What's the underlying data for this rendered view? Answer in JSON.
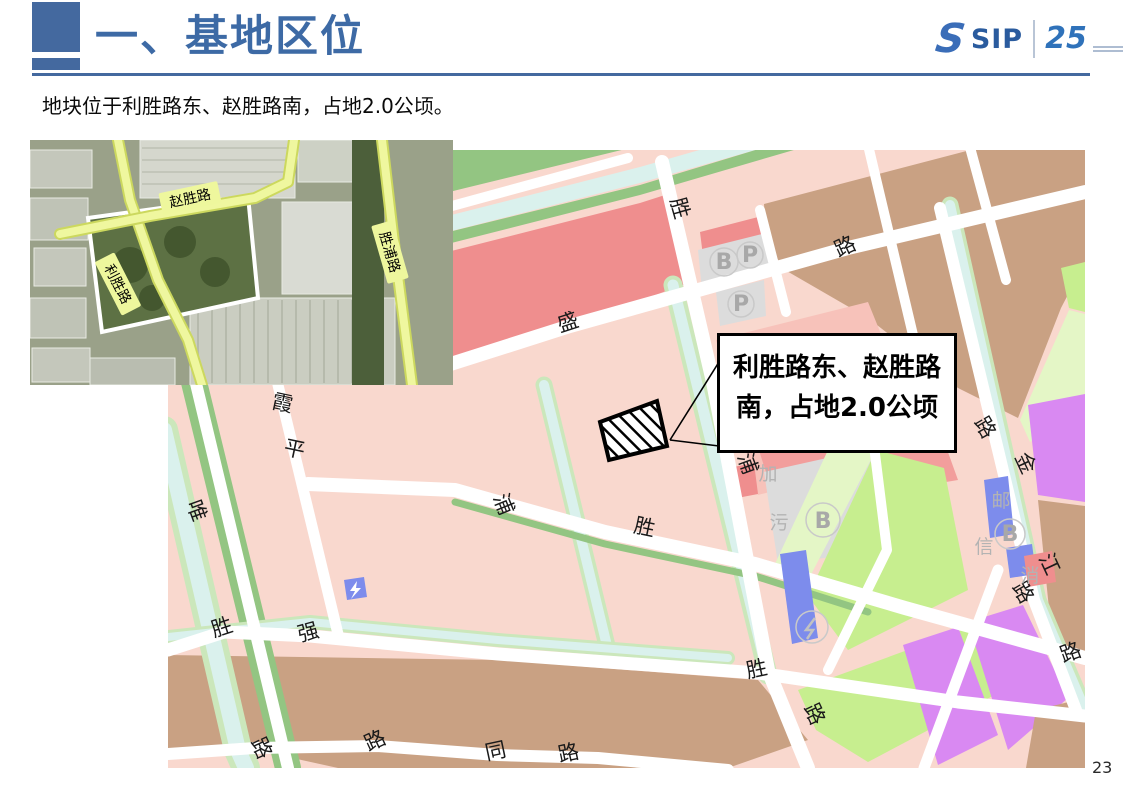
{
  "slide": {
    "title": "一、基地区位",
    "subtitle": "地块位于利胜路东、赵胜路南，占地2.0公顷。",
    "page_number": "23",
    "accent_color": "#44699f"
  },
  "logo": {
    "brand": "SIP",
    "anniversary": "25"
  },
  "callout": {
    "line1": "利胜路东、赵胜路",
    "line2": "南，占地2.0公顷"
  },
  "satellite": {
    "labels": [
      {
        "text": "赵胜路",
        "x": 160,
        "y": 58,
        "rot": -12
      },
      {
        "text": "利胜路",
        "x": 88,
        "y": 144,
        "rot": 63
      },
      {
        "text": "胜浦路",
        "x": 360,
        "y": 112,
        "rot": 74
      }
    ]
  },
  "map": {
    "colors": {
      "pink": "#f9d8ce",
      "pink_mid": "#f7c2ba",
      "pink_deep": "#f29e9c",
      "red": "#ef8e8e",
      "tan": "#c9a183",
      "green_strip": "#93c582",
      "green_light": "#c7ee8f",
      "green_pale": "#e4f6c6",
      "water": "#daf1ed",
      "water_edge": "#cbe7bb",
      "purple": "#d989f2",
      "blue": "#7d8cec",
      "gray": "#dcdcdc",
      "gray_text": "#b3b3b3",
      "road": "#ffffff"
    },
    "road_labels": [
      {
        "t": "胜",
        "x": 505,
        "y": 60,
        "r": 74
      },
      {
        "t": "盛",
        "x": 402,
        "y": 179,
        "r": -18
      },
      {
        "t": "路",
        "x": 680,
        "y": 103,
        "r": -25
      },
      {
        "t": "霞",
        "x": 113,
        "y": 260,
        "r": 12
      },
      {
        "t": "平",
        "x": 125,
        "y": 306,
        "r": 12
      },
      {
        "t": "唯",
        "x": 22,
        "y": 363,
        "r": 70
      },
      {
        "t": "浦",
        "x": 329,
        "y": 357,
        "r": 68
      },
      {
        "t": "胜",
        "x": 475,
        "y": 384,
        "r": 12
      },
      {
        "t": "浦",
        "x": 573,
        "y": 316,
        "r": 70
      },
      {
        "t": "金",
        "x": 851,
        "y": 316,
        "r": 65
      },
      {
        "t": "路",
        "x": 811,
        "y": 281,
        "r": 60
      },
      {
        "t": "江",
        "x": 875,
        "y": 417,
        "r": 65
      },
      {
        "t": "路",
        "x": 849,
        "y": 446,
        "r": 60
      },
      {
        "t": "路",
        "x": 905,
        "y": 509,
        "r": -20
      },
      {
        "t": "胜",
        "x": 590,
        "y": 526,
        "r": -12
      },
      {
        "t": "路",
        "x": 640,
        "y": 567,
        "r": 65
      },
      {
        "t": "胜",
        "x": 56,
        "y": 484,
        "r": -18
      },
      {
        "t": "强",
        "x": 142,
        "y": 489,
        "r": -15
      },
      {
        "t": "路",
        "x": 87,
        "y": 601,
        "r": 65
      },
      {
        "t": "路",
        "x": 210,
        "y": 597,
        "r": -25
      },
      {
        "t": "同",
        "x": 329,
        "y": 608,
        "r": -12
      },
      {
        "t": "路",
        "x": 402,
        "y": 610,
        "r": -12
      }
    ],
    "poi_labels": [
      {
        "t": "加",
        "x": 600,
        "y": 330
      },
      {
        "t": "污",
        "x": 611,
        "y": 379
      },
      {
        "t": "邮",
        "x": 833,
        "y": 357
      },
      {
        "t": "信",
        "x": 816,
        "y": 403
      },
      {
        "t": "消",
        "x": 862,
        "y": 432
      }
    ],
    "badges": [
      {
        "t": "B",
        "x": 556,
        "y": 119
      },
      {
        "t": "P",
        "x": 582,
        "y": 112
      },
      {
        "t": "P",
        "x": 573,
        "y": 161
      },
      {
        "t": "B",
        "x": 655,
        "y": 378
      },
      {
        "t": "B",
        "x": 842,
        "y": 391
      }
    ]
  }
}
